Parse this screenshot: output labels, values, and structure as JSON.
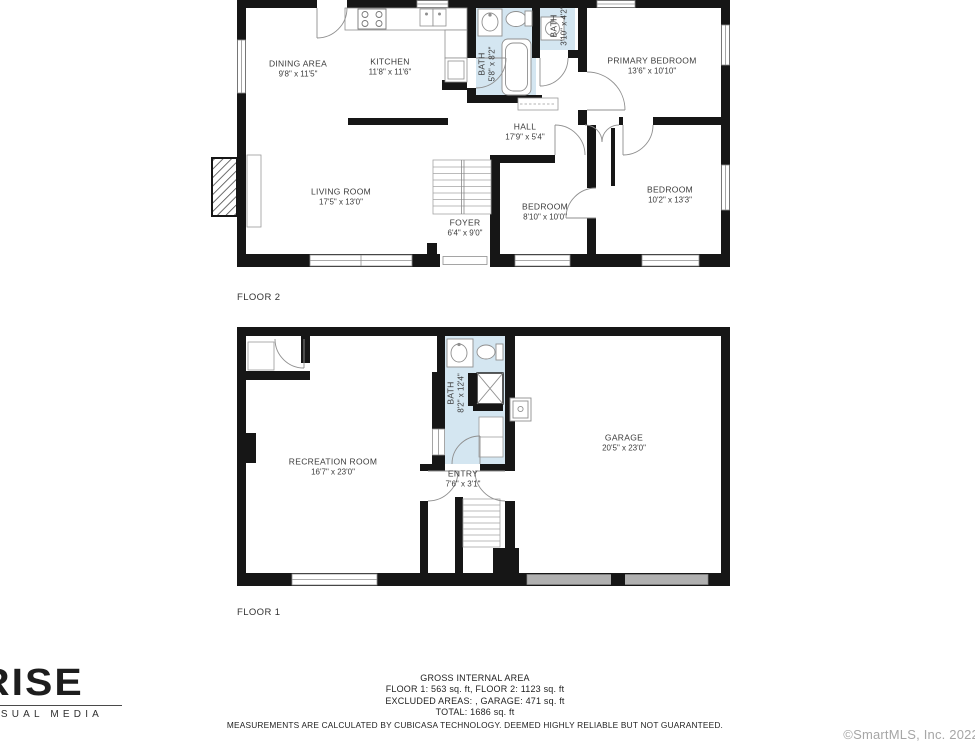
{
  "colors": {
    "wall": "#161616",
    "bath_fill": "#d4e6f1",
    "garage_door": "#b0b0b0",
    "label_text": "#3b3b3b"
  },
  "floor2": {
    "label": "FLOOR 2",
    "rooms": {
      "dining": {
        "name": "DINING AREA",
        "dims": "9'8\" x 11'5\""
      },
      "kitchen": {
        "name": "KITCHEN",
        "dims": "11'8\" x 11'6\""
      },
      "bath": {
        "name": "BATH",
        "dims": "5'8\" x 8'2\""
      },
      "bath_small": {
        "name": "BATH",
        "dims": "3'10\" x 4'2\""
      },
      "primary": {
        "name": "PRIMARY BEDROOM",
        "dims": "13'6\" x 10'10\""
      },
      "hall": {
        "name": "HALL",
        "dims": "17'9\" x 5'4\""
      },
      "living": {
        "name": "LIVING ROOM",
        "dims": "17'5\" x 13'0\""
      },
      "foyer": {
        "name": "FOYER",
        "dims": "6'4\" x 9'0\""
      },
      "bedroom1": {
        "name": "BEDROOM",
        "dims": "8'10\" x 10'0\""
      },
      "bedroom2": {
        "name": "BEDROOM",
        "dims": "10'2\" x 13'3\""
      }
    }
  },
  "floor1": {
    "label": "FLOOR 1",
    "rooms": {
      "recreation": {
        "name": "RECREATION ROOM",
        "dims": "16'7\" x 23'0\""
      },
      "bath": {
        "name": "BATH",
        "dims": "8'2\" x 12'4\""
      },
      "entry": {
        "name": "ENTRY",
        "dims": "7'6\" x 3'1\""
      },
      "garage": {
        "name": "GARAGE",
        "dims": "20'5\" x 23'0\""
      }
    }
  },
  "footer": {
    "line1": "GROSS INTERNAL AREA",
    "line2": "FLOOR 1: 563 sq. ft, FLOOR 2: 1123 sq. ft",
    "line3": "EXCLUDED AREAS: , GARAGE: 471 sq. ft",
    "line4": "TOTAL: 1686 sq. ft",
    "line5": "MEASUREMENTS ARE CALCULATED BY CUBICASA TECHNOLOGY. DEEMED HIGHLY RELIABLE BUT NOT GUARANTEED."
  },
  "branding": {
    "logo_title": "RISE",
    "logo_subtitle": "VISUAL MEDIA"
  },
  "copyright": "©SmartMLS, Inc. 2022"
}
